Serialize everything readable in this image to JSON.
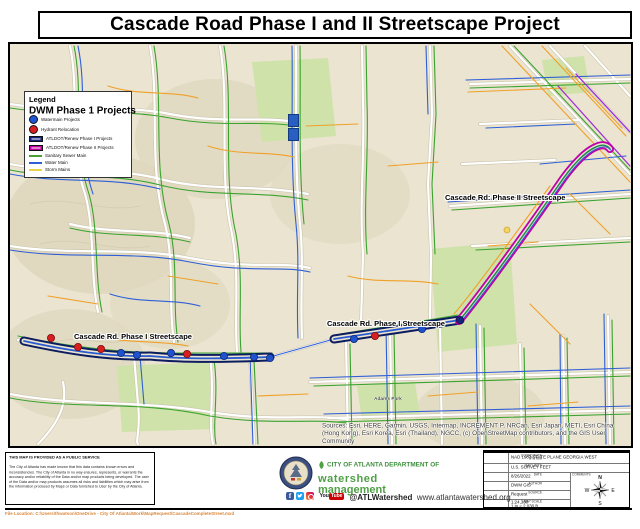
{
  "title": "Cascade Road Phase I and II Streetscape Project",
  "legend": {
    "title": "Legend",
    "subtitle": "DWM Phase 1 Projects",
    "items": [
      {
        "swatch": "circle-blue",
        "label": "Watermain Projects"
      },
      {
        "swatch": "circle-red",
        "label": "Hydrant Relocation"
      },
      {
        "swatch": "rect-navy",
        "label": "ATLDOT/Renew Phase I Projects"
      },
      {
        "swatch": "rect-magenta",
        "label": "ATLDOT/Renew Phase II Projects"
      },
      {
        "swatch": "line-green",
        "label": "Sanitary Sewer Main"
      },
      {
        "swatch": "line-blue",
        "label": "Water Main"
      },
      {
        "swatch": "line-yellow",
        "label": "Storm Mains"
      }
    ]
  },
  "map": {
    "labels": {
      "phase2": "Cascade Rd: Phase II Streetscape",
      "phase1_mid": "Cascade Rd. Phase I Streetscape",
      "phase1_left": "Cascade Rd. Phase I Streetscape",
      "adams_park": "Adams Park"
    },
    "attribution": "Sources: Esri, HERE, Garmin, USGS, Intermap, INCREMENT P, NRCan, Esri Japan, METI, Esri China (Hong Kong), Esri Korea, Esri (Thailand), NGCC, (c) OpenStreetMap contributors, and the GIS User Community"
  },
  "disclaimer": {
    "heading": "THIS MAP IS PROVIDED AS A PUBLIC SERVICE",
    "body": "The City of Atlanta has made known that this data contains known errors and inconsistencies. The City of Atlanta in no way ensures, represents, or warrants the accuracy and/or reliability of the Data and/or map products being developed. The user of the Data and/or map products assumes all risks and liabilities which may arise from the information produced by Maps or Data furnished to User by the City of Atlanta."
  },
  "branding": {
    "dept_line": "CITY OF ATLANTA DEPARTMENT OF",
    "name_line1": "watershed",
    "name_line2": "management",
    "youtube_you": "You",
    "youtube_tube": "Tube",
    "handle": "@ATLWatershed",
    "website": "www.atlantawatershed.org"
  },
  "info_table": {
    "rows": [
      {
        "label": "COORDINATE SYSTEM",
        "value": "NAD 1983 STATE PLANE GEORGIA WEST"
      },
      {
        "label": "MAP UNITS",
        "value": "U.S. SURVEY FEET"
      },
      {
        "label": "DATE",
        "value": "8/26/2022"
      },
      {
        "label": "AUTHOR",
        "value": "DWM GIS"
      },
      {
        "label": "SOURCE",
        "value": "Request"
      },
      {
        "label": "MAP SCALE",
        "value": "1:24,380",
        "value2": "1 in = 2,030 ft"
      }
    ],
    "comments_label": "COMMENTS",
    "compass": {
      "n": "N",
      "e": "E",
      "s": "S",
      "w": "W"
    }
  },
  "file_location": "File Location: C:\\Users\\thwatson\\OneDrive - City Of Atlanta\\Work\\MapRequest\\CascadeCompleteStreet.mxd",
  "colors": {
    "sanitary_sewer": "#4aa032",
    "water_main": "#2f5fd6",
    "storm_main": "#e6d44a",
    "phase1_corridor": "#14277f",
    "phase2_corridor": "#c400a0",
    "watermain_project": "#1d55d4",
    "hydrant_relocation": "#d81f1f"
  }
}
